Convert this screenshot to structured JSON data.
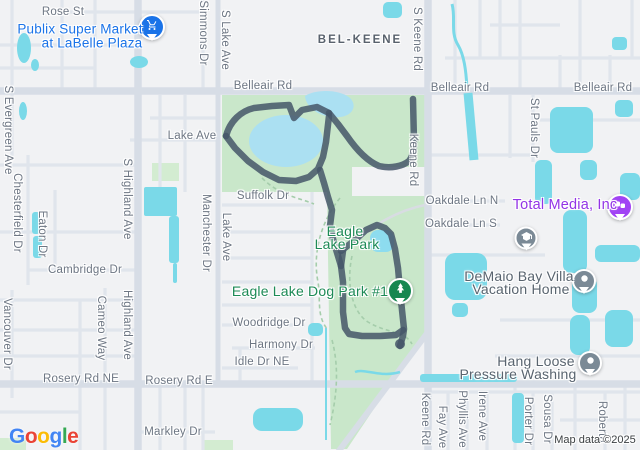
{
  "app": {
    "name": "Google Maps",
    "attribution": "Map data ©2025"
  },
  "colors": {
    "land": "#f1f2f4",
    "road_minor": "#e0e5ec",
    "road_major": "#d7dde6",
    "park": "#c9e7ca",
    "water": "#7ad9e8",
    "lake": "#abe0f2",
    "route": "#455669",
    "poi_blue": "#1a73e8",
    "poi_purple": "#9334e6",
    "poi_green": "#1d8a56",
    "pin_gray": "#7b8a96",
    "pin_tree_green": "#168750"
  },
  "logo": {
    "letters": [
      {
        "ch": "G",
        "color": "#4285F4"
      },
      {
        "ch": "o",
        "color": "#EA4335"
      },
      {
        "ch": "o",
        "color": "#FBBC05"
      },
      {
        "ch": "g",
        "color": "#4285F4"
      },
      {
        "ch": "l",
        "color": "#34A853"
      },
      {
        "ch": "e",
        "color": "#EA4335"
      }
    ]
  },
  "map": {
    "labels": [
      {
        "name": "road-label-rose-st",
        "text": "Rose St",
        "x": 63,
        "y": 12,
        "cls": "road",
        "v": false,
        "click": false
      },
      {
        "name": "poi-label-publix-line1",
        "text": "Publix Super Market",
        "x": 80,
        "y": 29,
        "cls": "poi-blue",
        "v": false,
        "click": true
      },
      {
        "name": "poi-label-publix-line2",
        "text": "at LaBelle Plaza",
        "x": 92,
        "y": 43,
        "cls": "poi-blue",
        "v": false,
        "click": true
      },
      {
        "name": "area-label-bel-keene",
        "text": "BEL-KEENE",
        "x": 360,
        "y": 40,
        "cls": "area",
        "v": false,
        "click": false
      },
      {
        "name": "road-label-belleair-rd-1",
        "text": "Belleair Rd",
        "x": 263,
        "y": 86,
        "cls": "road",
        "v": false,
        "click": false
      },
      {
        "name": "road-label-belleair-rd-2",
        "text": "Belleair Rd",
        "x": 460,
        "y": 88,
        "cls": "road",
        "v": false,
        "click": false
      },
      {
        "name": "road-label-belleair-rd-3",
        "text": "Belleair Rd",
        "x": 603,
        "y": 88,
        "cls": "road",
        "v": false,
        "click": false
      },
      {
        "name": "road-label-lake-ave-h",
        "text": "Lake Ave",
        "x": 192,
        "y": 136,
        "cls": "road",
        "v": false,
        "click": false
      },
      {
        "name": "road-label-suffolk-dr",
        "text": "Suffolk Dr",
        "x": 263,
        "y": 196,
        "cls": "road",
        "v": false,
        "click": false
      },
      {
        "name": "poi-label-eagle-lake-park-line1",
        "text": "Eagle",
        "x": 345,
        "y": 231,
        "cls": "poi-green",
        "v": false,
        "click": true
      },
      {
        "name": "poi-label-eagle-lake-park-line2",
        "text": "Lake Park",
        "x": 347,
        "y": 244,
        "cls": "poi-green",
        "v": false,
        "click": true
      },
      {
        "name": "poi-label-eagle-lake-dog-park",
        "text": "Eagle Lake Dog Park #1",
        "x": 310,
        "y": 291,
        "cls": "poi-green",
        "v": false,
        "click": true
      },
      {
        "name": "road-label-oakdale-ln-n",
        "text": "Oakdale Ln N",
        "x": 462,
        "y": 201,
        "cls": "road",
        "v": false,
        "click": false
      },
      {
        "name": "road-label-oakdale-ln-s",
        "text": "Oakdale Ln S",
        "x": 461,
        "y": 224,
        "cls": "road",
        "v": false,
        "click": false
      },
      {
        "name": "poi-label-total-media",
        "text": "Total Media, Inc",
        "x": 565,
        "y": 205,
        "cls": "poi-purple",
        "v": false,
        "click": true
      },
      {
        "name": "poi-label-demaio-line1",
        "text": "DeMaio Bay Villa",
        "x": 519,
        "y": 276,
        "cls": "poi-dark",
        "v": false,
        "click": true
      },
      {
        "name": "poi-label-demaio-line2",
        "text": "Vacation Home",
        "x": 521,
        "y": 289,
        "cls": "poi-dark",
        "v": false,
        "click": true
      },
      {
        "name": "poi-label-hang-loose-line1",
        "text": "Hang Loose",
        "x": 536,
        "y": 361,
        "cls": "poi-dark",
        "v": false,
        "click": true
      },
      {
        "name": "poi-label-hang-loose-line2",
        "text": "Pressure Washing",
        "x": 518,
        "y": 374,
        "cls": "poi-dark",
        "v": false,
        "click": true
      },
      {
        "name": "road-label-cambridge-dr",
        "text": "Cambridge Dr",
        "x": 85,
        "y": 270,
        "cls": "road",
        "v": false,
        "click": false
      },
      {
        "name": "road-label-rosery-rd-ne",
        "text": "Rosery Rd NE",
        "x": 81,
        "y": 379,
        "cls": "road",
        "v": false,
        "click": false
      },
      {
        "name": "road-label-rosery-rd-e",
        "text": "Rosery Rd E",
        "x": 179,
        "y": 381,
        "cls": "road",
        "v": false,
        "click": false
      },
      {
        "name": "road-label-markley-dr",
        "text": "Markley Dr",
        "x": 173,
        "y": 432,
        "cls": "road",
        "v": false,
        "click": false
      },
      {
        "name": "road-label-woodridge-dr",
        "text": "Woodridge Dr",
        "x": 269,
        "y": 323,
        "cls": "road",
        "v": false,
        "click": false
      },
      {
        "name": "road-label-harmony-dr",
        "text": "Harmony Dr",
        "x": 281,
        "y": 345,
        "cls": "road",
        "v": false,
        "click": false
      },
      {
        "name": "road-label-idle-dr-ne",
        "text": "Idle Dr NE",
        "x": 262,
        "y": 362,
        "cls": "road",
        "v": false,
        "click": false
      },
      {
        "name": "road-label-s-evergreen-ave",
        "text": "S Evergreen Ave",
        "x": 8,
        "y": 130,
        "cls": "road",
        "v": true,
        "click": false
      },
      {
        "name": "road-label-chesterfield-dr",
        "text": "Chesterfield Dr",
        "x": 17,
        "y": 213,
        "cls": "road",
        "v": true,
        "click": false
      },
      {
        "name": "road-label-eaton-dr",
        "text": "Eaton Dr",
        "x": 42,
        "y": 234,
        "cls": "road",
        "v": true,
        "click": false
      },
      {
        "name": "road-label-vancouver-dr",
        "text": "Vancouver Dr",
        "x": 7,
        "y": 334,
        "cls": "road",
        "v": true,
        "click": false
      },
      {
        "name": "road-label-cameo-way",
        "text": "Cameo Way",
        "x": 101,
        "y": 328,
        "cls": "road",
        "v": true,
        "click": false
      },
      {
        "name": "road-label-s-highland-ave",
        "text": "S Highland Ave",
        "x": 127,
        "y": 199,
        "cls": "road",
        "v": true,
        "click": false
      },
      {
        "name": "road-label-highland-ave",
        "text": "Highland Ave",
        "x": 127,
        "y": 325,
        "cls": "road",
        "v": true,
        "click": false
      },
      {
        "name": "road-label-manchester-dr",
        "text": "Manchester Dr",
        "x": 206,
        "y": 233,
        "cls": "road",
        "v": true,
        "click": false
      },
      {
        "name": "road-label-simmons-dr",
        "text": "Simmons Dr",
        "x": 203,
        "y": 33,
        "cls": "road",
        "v": true,
        "click": false
      },
      {
        "name": "road-label-s-lake-ave",
        "text": "S Lake Ave",
        "x": 225,
        "y": 40,
        "cls": "road",
        "v": true,
        "click": false
      },
      {
        "name": "road-label-lake-ave-v",
        "text": "Lake Ave",
        "x": 226,
        "y": 237,
        "cls": "road",
        "v": true,
        "click": false
      },
      {
        "name": "road-label-s-keene-rd",
        "text": "S Keene Rd",
        "x": 417,
        "y": 39,
        "cls": "road",
        "v": true,
        "click": false
      },
      {
        "name": "road-label-keene-rd-upper",
        "text": "Keene Rd",
        "x": 413,
        "y": 160,
        "cls": "road",
        "v": true,
        "click": false
      },
      {
        "name": "road-label-keene-rd-lower",
        "text": "Keene Rd",
        "x": 425,
        "y": 419,
        "cls": "road",
        "v": true,
        "click": false
      },
      {
        "name": "road-label-st-pauls-dr",
        "text": "St Pauls Dr",
        "x": 534,
        "y": 128,
        "cls": "road",
        "v": true,
        "click": false
      },
      {
        "name": "road-label-fay-ave",
        "text": "Fay Ave",
        "x": 442,
        "y": 427,
        "cls": "road",
        "v": true,
        "click": false
      },
      {
        "name": "road-label-phyllis-ave",
        "text": "Phyllis Ave",
        "x": 462,
        "y": 419,
        "cls": "road",
        "v": true,
        "click": false
      },
      {
        "name": "road-label-irene-ave",
        "text": "Irene Ave",
        "x": 482,
        "y": 416,
        "cls": "road",
        "v": true,
        "click": false
      },
      {
        "name": "road-label-porter-dr",
        "text": "Porter Dr",
        "x": 528,
        "y": 421,
        "cls": "road",
        "v": true,
        "click": false
      },
      {
        "name": "road-label-sousa-dr",
        "text": "Sousa Dr",
        "x": 547,
        "y": 419,
        "cls": "road",
        "v": true,
        "click": false
      },
      {
        "name": "road-label-roberta",
        "text": "Roberta",
        "x": 602,
        "y": 422,
        "cls": "road",
        "v": true,
        "click": false
      },
      {
        "name": "map-attribution",
        "text": "Map data ©2025",
        "x": 595,
        "y": 440,
        "cls": "attr",
        "v": false,
        "click": false
      }
    ],
    "markers": [
      {
        "name": "publix-store-marker",
        "glyph": "cart-icon",
        "color": "#1a73e8",
        "x": 152,
        "y": 27,
        "size": 22
      },
      {
        "name": "total-media-marker",
        "glyph": "business-icon",
        "color": "#a142f4",
        "x": 620,
        "y": 207,
        "size": 22
      },
      {
        "name": "school-marker",
        "glyph": "school-icon",
        "color": "#7b8a96",
        "x": 526,
        "y": 238,
        "size": 19
      },
      {
        "name": "demaio-lodging-marker",
        "glyph": "dot-icon",
        "color": "#7b8a96",
        "x": 584,
        "y": 281,
        "size": 20
      },
      {
        "name": "hang-loose-marker",
        "glyph": "dot-icon",
        "color": "#7b8a96",
        "x": 590,
        "y": 363,
        "size": 20
      },
      {
        "name": "dog-park-tree-marker",
        "glyph": "tree-icon",
        "color": "#168750",
        "x": 400,
        "y": 291,
        "size": 22
      }
    ]
  }
}
